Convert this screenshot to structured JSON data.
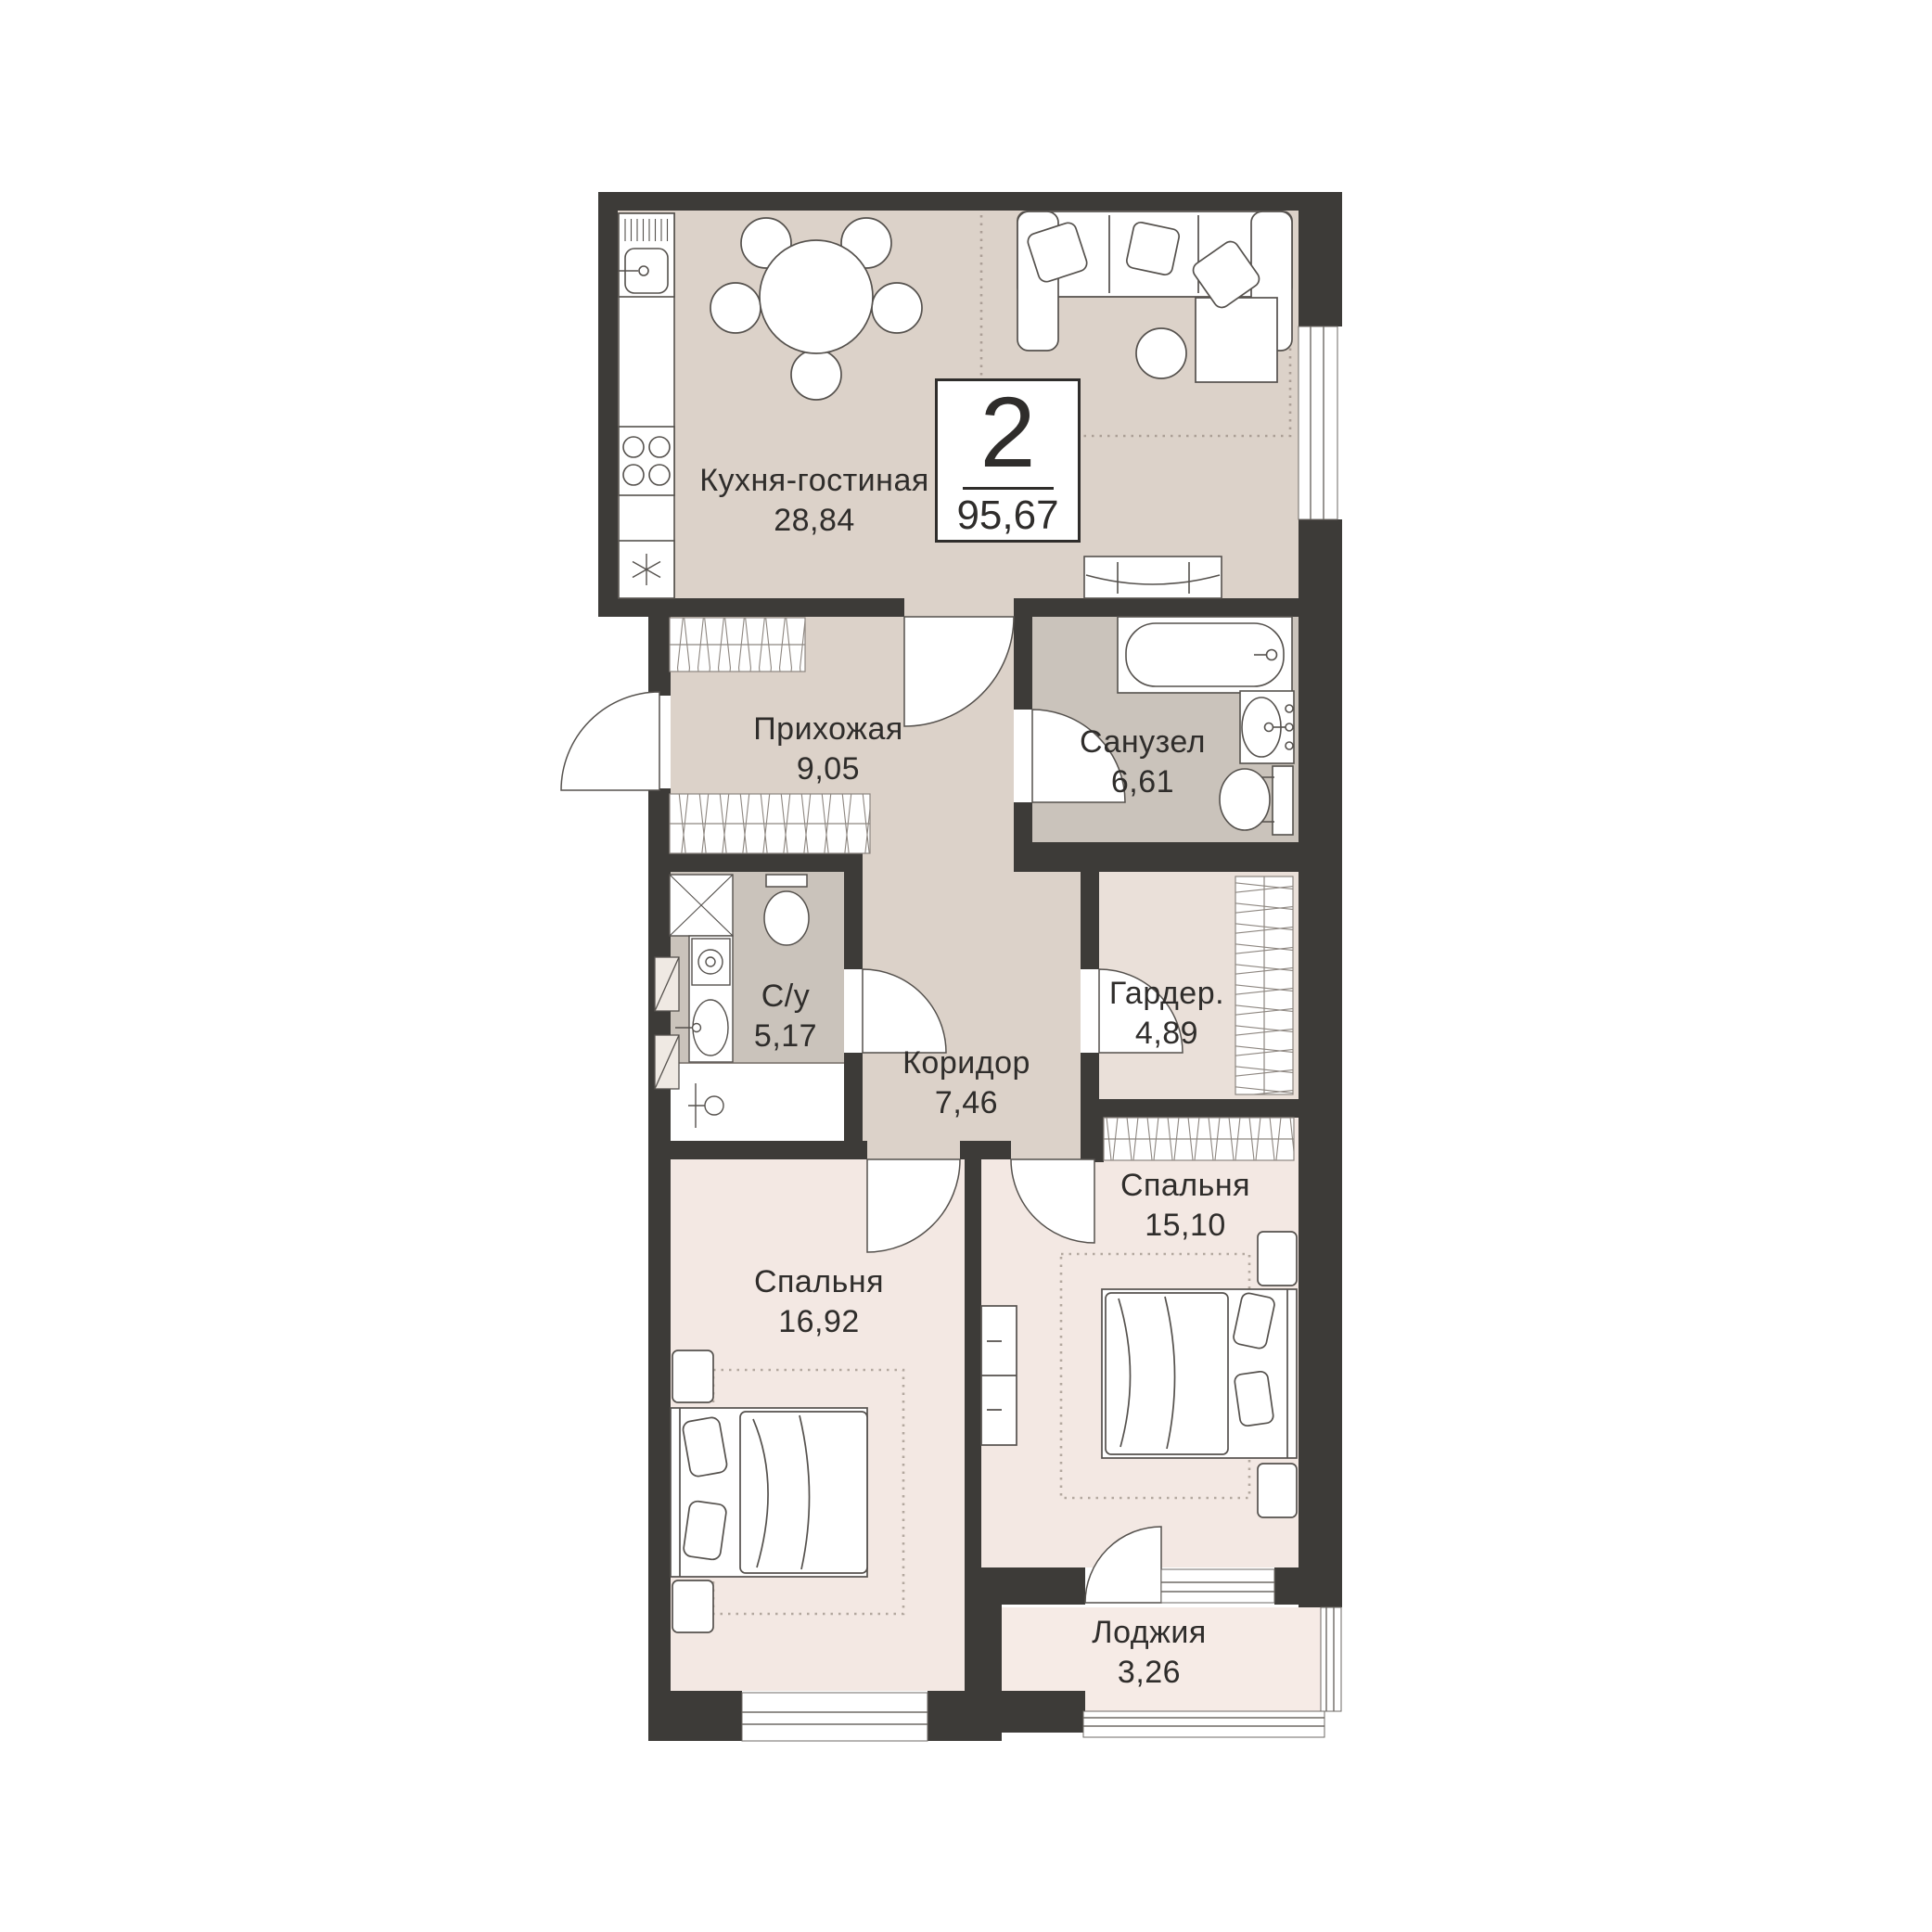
{
  "plan": {
    "badge": {
      "rooms_count": "2",
      "total_area": "95,67"
    },
    "rooms": [
      {
        "id": "kitchen-living",
        "name": "Кухня-гостиная",
        "area": "28,84"
      },
      {
        "id": "hallway",
        "name": "Прихожая",
        "area": "9,05"
      },
      {
        "id": "bathroom",
        "name": "Санузел",
        "area": "6,61"
      },
      {
        "id": "wc",
        "name": "С/у",
        "area": "5,17"
      },
      {
        "id": "corridor",
        "name": "Коридор",
        "area": "7,46"
      },
      {
        "id": "wardrobe",
        "name": "Гардер.",
        "area": "4,89"
      },
      {
        "id": "bedroom-1",
        "name": "Спальня",
        "area": "15,10"
      },
      {
        "id": "bedroom-2",
        "name": "Спальня",
        "area": "16,92"
      },
      {
        "id": "loggia",
        "name": "Лоджия",
        "area": "3,26"
      }
    ],
    "colors": {
      "wall": "#3d3b38",
      "floor_main": "#dcd2c9",
      "floor_wet": "#cac3bb",
      "floor_bedroom": "#f3e8e3",
      "floor_wardrobe": "#eae0d9",
      "floor_loggia": "#f6ebe6",
      "outline": "#55514d"
    }
  }
}
